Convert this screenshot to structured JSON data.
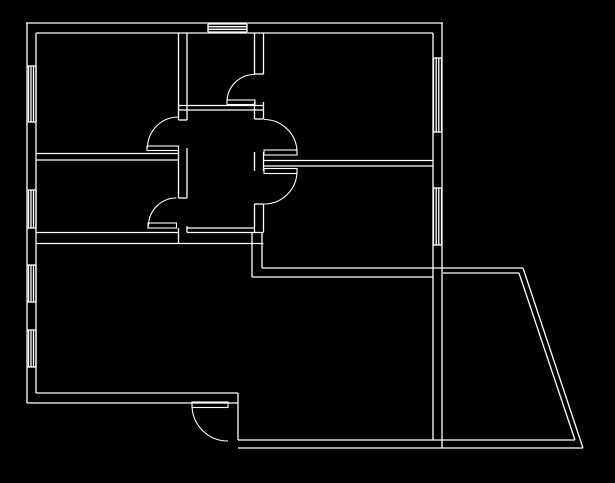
{
  "app": {
    "title": "CAD floor plan drawing canvas",
    "background_color": "#000000",
    "line_color": "#ffffff",
    "canvas": {
      "width": 615,
      "height": 483
    }
  },
  "floorplan": {
    "stroke_width": 1.3,
    "walls": [
      [
        26,
        23,
        443,
        23
      ],
      [
        36,
        33,
        433,
        33
      ],
      [
        27,
        23,
        27,
        403
      ],
      [
        36,
        33,
        36,
        393
      ],
      [
        442,
        23,
        442,
        448
      ],
      [
        433,
        33,
        433,
        440
      ],
      [
        27,
        403,
        238,
        403
      ],
      [
        36,
        393,
        238,
        393
      ],
      [
        238,
        393,
        238,
        440
      ],
      [
        238,
        448,
        583,
        448
      ],
      [
        238,
        440,
        575,
        440
      ],
      [
        262,
        268,
        523,
        268
      ],
      [
        443,
        273,
        519,
        273
      ],
      [
        252,
        277,
        433,
        277
      ],
      [
        523,
        268,
        583,
        448
      ],
      [
        519,
        273,
        575,
        440
      ],
      [
        178.5,
        33,
        178.5,
        120
      ],
      [
        178.5,
        150,
        178.5,
        198
      ],
      [
        178.5,
        228,
        178.5,
        243.5
      ],
      [
        187,
        33,
        187,
        120
      ],
      [
        187,
        148,
        187,
        198
      ],
      [
        187,
        226,
        187,
        232.5
      ],
      [
        178.5,
        120,
        187,
        120
      ],
      [
        178.5,
        198,
        187,
        198
      ],
      [
        254.5,
        33,
        254.5,
        74
      ],
      [
        254.5,
        102,
        254.5,
        119
      ],
      [
        254.5,
        152,
        254.5,
        171
      ],
      [
        254.5,
        204,
        254.5,
        232.5
      ],
      [
        263.5,
        33,
        263.5,
        74
      ],
      [
        263.5,
        102,
        263.5,
        119
      ],
      [
        263.5,
        152,
        263.5,
        171
      ],
      [
        263.5,
        204,
        263.5,
        232.5
      ],
      [
        254.5,
        74,
        263.5,
        74
      ],
      [
        254.5,
        119,
        263.5,
        119
      ],
      [
        254.5,
        204,
        263.5,
        204
      ],
      [
        36,
        153.5,
        178.5,
        153.5
      ],
      [
        36,
        160,
        178.5,
        160
      ],
      [
        178.5,
        105.5,
        263.5,
        105.5
      ],
      [
        178.5,
        110,
        263.5,
        110
      ],
      [
        187,
        228,
        254.5,
        228
      ],
      [
        36,
        232.5,
        178.5,
        232.5
      ],
      [
        187,
        232.5,
        263.5,
        232.5
      ],
      [
        36,
        243.5,
        263.5,
        243.5
      ],
      [
        252,
        232.5,
        252,
        277
      ],
      [
        262,
        232.5,
        262,
        268
      ],
      [
        263.5,
        160.5,
        433,
        160.5
      ],
      [
        263.5,
        166,
        433,
        166
      ]
    ],
    "windows": [
      {
        "id": "window-top-center",
        "segments": [
          [
            208,
            24,
            247,
            24
          ],
          [
            208,
            26.7,
            247,
            26.7
          ],
          [
            208,
            29.3,
            247,
            29.3
          ],
          [
            208,
            32,
            247,
            32
          ],
          [
            208,
            24,
            208,
            32
          ],
          [
            247,
            24,
            247,
            32
          ]
        ]
      },
      {
        "id": "window-left-1",
        "segments": [
          [
            28.5,
            66,
            28.5,
            122
          ],
          [
            31,
            66,
            31,
            122
          ],
          [
            33.5,
            66,
            33.5,
            122
          ],
          [
            36,
            66,
            36,
            122
          ],
          [
            27,
            66,
            36,
            66
          ],
          [
            27,
            122,
            36,
            122
          ]
        ]
      },
      {
        "id": "window-left-2",
        "segments": [
          [
            28.5,
            190,
            28.5,
            228
          ],
          [
            31,
            190,
            31,
            228
          ],
          [
            33.5,
            190,
            33.5,
            228
          ],
          [
            36,
            190,
            36,
            228
          ],
          [
            27,
            190,
            36,
            190
          ],
          [
            27,
            228,
            36,
            228
          ]
        ]
      },
      {
        "id": "window-left-3",
        "segments": [
          [
            28.5,
            265,
            28.5,
            302
          ],
          [
            31,
            265,
            31,
            302
          ],
          [
            33.5,
            265,
            33.5,
            302
          ],
          [
            36,
            265,
            36,
            302
          ],
          [
            27,
            265,
            36,
            265
          ],
          [
            27,
            302,
            36,
            302
          ]
        ]
      },
      {
        "id": "window-left-4",
        "segments": [
          [
            28.5,
            330,
            28.5,
            367
          ],
          [
            31,
            330,
            31,
            367
          ],
          [
            33.5,
            330,
            33.5,
            367
          ],
          [
            36,
            330,
            36,
            367
          ],
          [
            27,
            330,
            36,
            330
          ],
          [
            27,
            367,
            36,
            367
          ]
        ]
      },
      {
        "id": "window-right-1",
        "segments": [
          [
            433.5,
            58,
            433.5,
            132
          ],
          [
            436.2,
            58,
            436.2,
            132
          ],
          [
            438.8,
            58,
            438.8,
            132
          ],
          [
            441.5,
            58,
            441.5,
            132
          ],
          [
            433,
            58,
            442,
            58
          ],
          [
            433,
            132,
            442,
            132
          ]
        ]
      },
      {
        "id": "window-right-2",
        "segments": [
          [
            433.5,
            188,
            433.5,
            245
          ],
          [
            436.2,
            188,
            436.2,
            245
          ],
          [
            438.8,
            188,
            438.8,
            245
          ],
          [
            441.5,
            188,
            441.5,
            245
          ],
          [
            433,
            188,
            442,
            188
          ],
          [
            433,
            245,
            442,
            245
          ]
        ]
      }
    ],
    "doors": [
      {
        "id": "door-top-left-room",
        "leaf": [
          147,
          146,
          31.5,
          4.5
        ],
        "arc": {
          "x1": 147.5,
          "y1": 148,
          "r": 31,
          "sweep": 1,
          "x2": 178.5,
          "y2": 117
        }
      },
      {
        "id": "door-center-room",
        "leaf": [
          227,
          100,
          28,
          4.5
        ],
        "arc": {
          "x1": 227,
          "y1": 102,
          "r": 27.5,
          "sweep": 1,
          "x2": 254.5,
          "y2": 74.5
        }
      },
      {
        "id": "door-mid-left-room",
        "leaf": [
          148,
          223,
          28.5,
          5
        ],
        "arc": {
          "x1": 148.5,
          "y1": 226,
          "r": 28,
          "sweep": 1,
          "x2": 176.5,
          "y2": 198
        }
      },
      {
        "id": "door-top-right-room",
        "leaf": [
          264,
          150,
          33,
          5
        ],
        "arc": {
          "x1": 264,
          "y1": 119.5,
          "r": 33,
          "sweep": 1,
          "x2": 297,
          "y2": 152.5
        }
      },
      {
        "id": "door-mid-right-room",
        "leaf": [
          264,
          168.5,
          33,
          5
        ],
        "arc": {
          "x1": 297,
          "y1": 171,
          "r": 33,
          "sweep": 1,
          "x2": 264,
          "y2": 204
        }
      },
      {
        "id": "door-entrance",
        "leaf": [
          192,
          402,
          36,
          5.5
        ],
        "arc": {
          "x1": 192,
          "y1": 405,
          "r": 36,
          "sweep": 0,
          "x2": 228,
          "y2": 441
        }
      }
    ]
  }
}
